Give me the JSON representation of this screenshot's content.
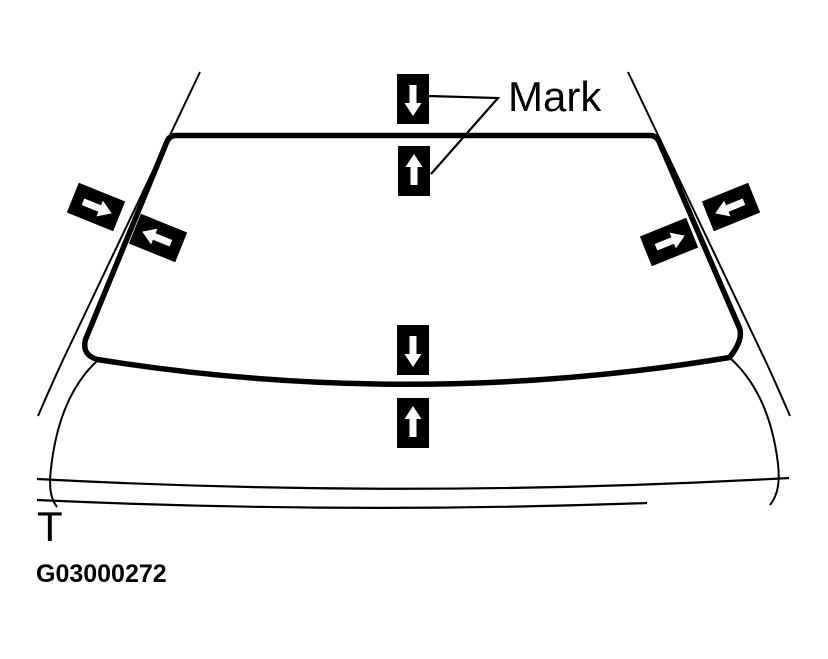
{
  "figure": {
    "mark_label": "Mark",
    "body_point_label": "T",
    "figure_id": "G03000272"
  },
  "colors": {
    "background": "#ffffff",
    "line": "#000000",
    "marker_fill": "#000000",
    "marker_arrow": "#ffffff"
  },
  "markers": [
    {
      "id": "top-outside",
      "icon": "arrow-down-icon",
      "direction": "down",
      "x": 413,
      "y": 99,
      "rotate": 90
    },
    {
      "id": "top-inside",
      "icon": "arrow-up-icon",
      "direction": "up",
      "x": 414,
      "y": 171,
      "rotate": -90
    },
    {
      "id": "left-outside",
      "icon": "arrow-right-icon",
      "direction": "right",
      "x": 96,
      "y": 207,
      "rotate": 22
    },
    {
      "id": "left-inside",
      "icon": "arrow-left-icon",
      "direction": "left",
      "x": 158,
      "y": 238,
      "rotate": 202
    },
    {
      "id": "right-inside",
      "icon": "arrow-right-icon",
      "direction": "right",
      "x": 669,
      "y": 242,
      "rotate": -22
    },
    {
      "id": "right-outside",
      "icon": "arrow-left-icon",
      "direction": "left",
      "x": 731,
      "y": 207,
      "rotate": 158
    },
    {
      "id": "bottom-outside",
      "icon": "arrow-down-icon",
      "direction": "down",
      "x": 413,
      "y": 350,
      "rotate": 90
    },
    {
      "id": "bottom-inside",
      "icon": "arrow-up-icon",
      "direction": "up",
      "x": 413,
      "y": 423,
      "rotate": -90
    }
  ]
}
